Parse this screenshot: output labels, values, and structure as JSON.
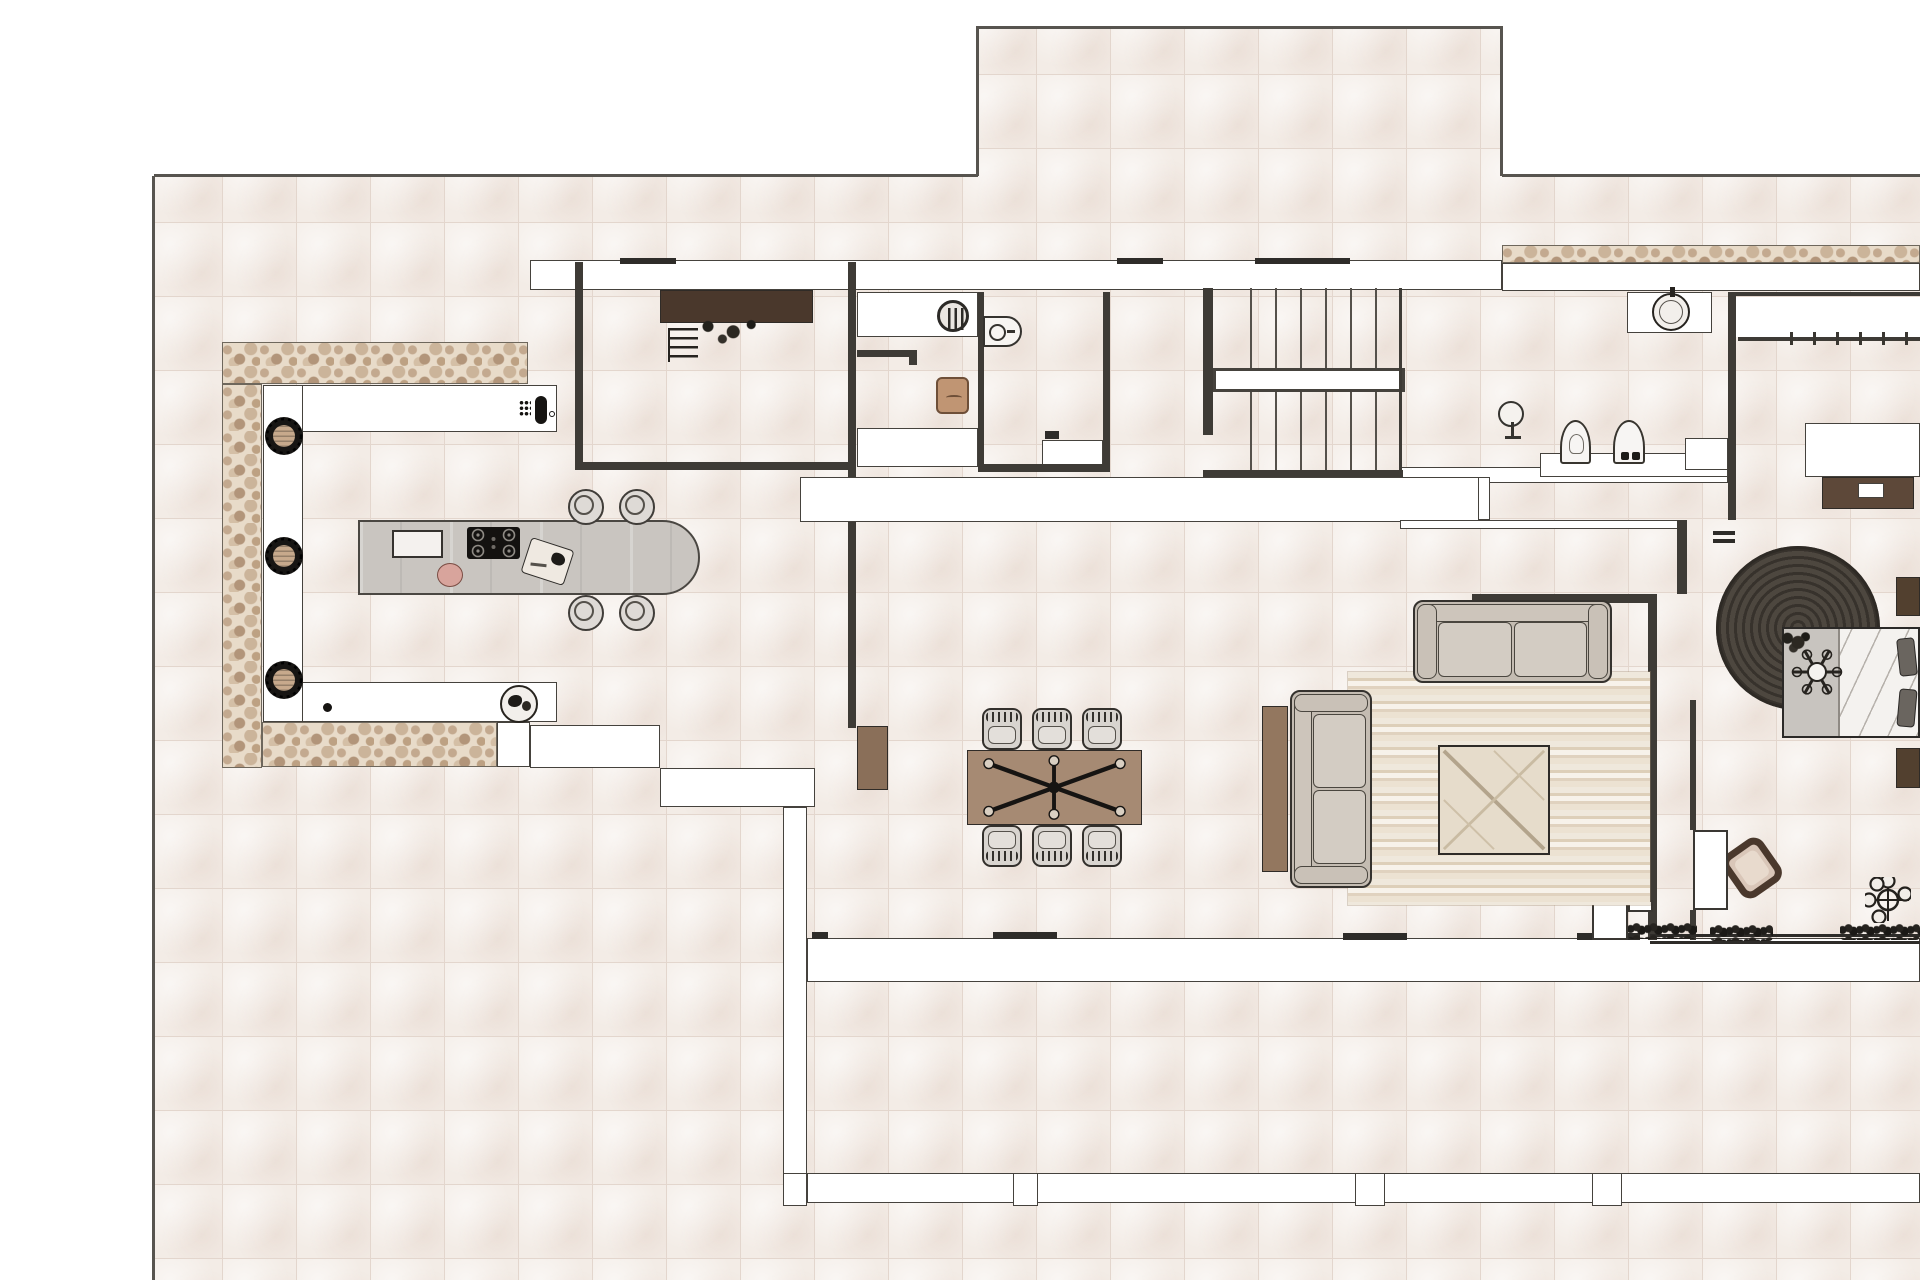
{
  "document": {
    "kind": "architectural-floor-plan",
    "title": "residential-floor-plan-top-view",
    "canvas": {
      "width": 1920,
      "height": 1280
    },
    "visible_text": [],
    "tile_size_px": 74
  },
  "palette": {
    "page": "#ffffff",
    "tile": "#f3ece6",
    "grout": "#e3d6cd",
    "wall_fill": "#ffffff",
    "wall_edge": "#45423d",
    "line": "#3e3b36",
    "boundary": "#57544f",
    "stone": "#e8dbc9",
    "island_gray": "#c9c5c0",
    "sofa_beige": "#cdc5bb",
    "wood_mid": "#a68a73",
    "wood_dark": "#4a382c",
    "wood_red": "#8a6f59",
    "rug_round": "#453f39",
    "tan": "#c7a98c",
    "pink": "#d8a49c",
    "hedge": "#1f1d1a",
    "black": "#161412",
    "chair_gray": "#d8d4cf"
  },
  "elements": [
    {
      "n": "site-tiles-left",
      "k": "tiles",
      "b": [
        154,
        176,
        824,
        1104
      ]
    },
    {
      "n": "site-tiles-upper",
      "k": "tiles",
      "b": [
        978,
        28,
        524,
        1252
      ]
    },
    {
      "n": "site-tiles-right",
      "k": "tiles",
      "b": [
        1502,
        176,
        418,
        1104
      ]
    },
    {
      "n": "boundary-left",
      "k": "line",
      "b": [
        152,
        176,
        3,
        1104
      ],
      "c": "#57544f"
    },
    {
      "n": "boundary-top-left",
      "k": "line",
      "b": [
        154,
        174,
        824,
        3
      ],
      "c": "#57544f"
    },
    {
      "n": "boundary-upper-terrace-left",
      "k": "line",
      "b": [
        976,
        28,
        3,
        148
      ],
      "c": "#57544f"
    },
    {
      "n": "boundary-upper-terrace-top",
      "k": "line",
      "b": [
        976,
        26,
        527,
        3
      ],
      "c": "#57544f"
    },
    {
      "n": "boundary-upper-terrace-right",
      "k": "line",
      "b": [
        1500,
        28,
        3,
        148
      ],
      "c": "#57544f"
    },
    {
      "n": "boundary-top-right",
      "k": "line",
      "b": [
        1502,
        174,
        418,
        3
      ],
      "c": "#57544f"
    },
    {
      "n": "stone-wall-kitchen-north",
      "k": "stone",
      "b": [
        222,
        342,
        306,
        42
      ]
    },
    {
      "n": "stone-wall-kitchen-west",
      "k": "stone",
      "b": [
        222,
        384,
        40,
        384
      ]
    },
    {
      "n": "stone-wall-kitchen-south",
      "k": "stone",
      "b": [
        262,
        722,
        235,
        45
      ]
    },
    {
      "n": "stone-band-northeast",
      "k": "stone",
      "b": [
        1502,
        245,
        418,
        18
      ]
    },
    {
      "n": "north-wall-band",
      "k": "wall",
      "b": [
        530,
        260,
        972,
        30
      ]
    },
    {
      "n": "north-wall-band-east",
      "k": "wall",
      "b": [
        1502,
        263,
        418,
        28
      ]
    },
    {
      "n": "kitchen-counter-top",
      "k": "wall",
      "b": [
        263,
        385,
        294,
        47
      ]
    },
    {
      "n": "kitchen-counter-left",
      "k": "wall",
      "b": [
        263,
        385,
        40,
        337
      ]
    },
    {
      "n": "kitchen-counter-bottom",
      "k": "wall",
      "b": [
        302,
        682,
        255,
        40
      ]
    },
    {
      "n": "south-wall-pillar",
      "k": "wall",
      "b": [
        497,
        722,
        33,
        45
      ]
    },
    {
      "n": "south-sill-kitchen",
      "k": "wall",
      "b": [
        530,
        725,
        130,
        43
      ]
    },
    {
      "n": "south-sill-step",
      "k": "wall",
      "b": [
        660,
        768,
        155,
        39
      ]
    },
    {
      "n": "west-glass-wall",
      "k": "wall",
      "b": [
        783,
        807,
        24,
        398
      ]
    },
    {
      "n": "south-wall-band",
      "k": "wall",
      "b": [
        807,
        938,
        1113,
        44
      ]
    },
    {
      "n": "terrace-parapet",
      "k": "wall",
      "b": [
        807,
        1173,
        1113,
        30
      ]
    },
    {
      "n": "parapet-post-1",
      "k": "wall",
      "b": [
        783,
        1173,
        24,
        33
      ]
    },
    {
      "n": "parapet-post-2",
      "k": "wall",
      "b": [
        1013,
        1173,
        25,
        33
      ]
    },
    {
      "n": "parapet-post-3",
      "k": "wall",
      "b": [
        1355,
        1173,
        30,
        33
      ]
    },
    {
      "n": "parapet-post-4",
      "k": "wall",
      "b": [
        1592,
        1173,
        30,
        33
      ]
    },
    {
      "n": "hall-wall-band",
      "k": "wall",
      "b": [
        1400,
        467,
        328,
        16
      ]
    },
    {
      "n": "hall-cabinet-row",
      "k": "wall",
      "b": [
        800,
        477,
        690,
        45
      ]
    },
    {
      "n": "hall-wall-lower",
      "k": "wall",
      "b": [
        1400,
        520,
        283,
        9
      ]
    },
    {
      "n": "hall-wall-connector",
      "k": "wall",
      "b": [
        1478,
        477,
        12,
        43
      ]
    },
    {
      "n": "laundry-closet-top",
      "k": "wall",
      "b": [
        857,
        292,
        121,
        45
      ]
    },
    {
      "n": "laundry-closet-bottom",
      "k": "wall",
      "b": [
        857,
        428,
        121,
        39
      ]
    },
    {
      "n": "stair-handrail",
      "k": "wall",
      "b": [
        1213,
        368,
        192,
        24
      ],
      "bw": "3px"
    },
    {
      "n": "bath-sink-counter",
      "k": "wall",
      "b": [
        1627,
        292,
        85,
        41
      ]
    },
    {
      "n": "bath-fixture-step",
      "k": "wall",
      "b": [
        1540,
        453,
        188,
        24
      ]
    },
    {
      "n": "shower-bench",
      "k": "wall",
      "b": [
        1042,
        440,
        61,
        27
      ]
    },
    {
      "n": "bath-wall-niche",
      "k": "wall",
      "b": [
        1685,
        438,
        43,
        32
      ]
    },
    {
      "n": "bedroom-closet-band",
      "k": "wall",
      "b": [
        1736,
        297,
        184,
        40
      ],
      "bw": "0px"
    },
    {
      "n": "wall-utility-west",
      "k": "line",
      "b": [
        575,
        262,
        8,
        205
      ]
    },
    {
      "n": "wall-dining-west-upper",
      "k": "line",
      "b": [
        848,
        262,
        8,
        215
      ]
    },
    {
      "n": "wall-dining-west-lower",
      "k": "line",
      "b": [
        848,
        522,
        8,
        206
      ]
    },
    {
      "n": "wall-shower-west",
      "k": "line",
      "b": [
        978,
        292,
        6,
        178
      ]
    },
    {
      "n": "wall-shower-east",
      "k": "line",
      "b": [
        1103,
        292,
        7,
        178
      ]
    },
    {
      "n": "wall-utility-south",
      "k": "line",
      "b": [
        575,
        462,
        281,
        8
      ]
    },
    {
      "n": "wall-shower-south",
      "k": "line",
      "b": [
        978,
        464,
        132,
        8
      ]
    },
    {
      "n": "wall-stairs-south",
      "k": "line",
      "b": [
        1203,
        470,
        200,
        7
      ]
    },
    {
      "n": "stair-left-rail",
      "k": "line",
      "b": [
        1203,
        288,
        10,
        147
      ]
    },
    {
      "n": "stair-right-edge",
      "k": "line",
      "b": [
        1399,
        288,
        3,
        182
      ]
    },
    {
      "n": "wall-lobby-south",
      "k": "line",
      "b": [
        1472,
        594,
        185,
        9
      ]
    },
    {
      "n": "wall-living-bedroom",
      "k": "line",
      "b": [
        1648,
        594,
        9,
        346
      ]
    },
    {
      "n": "wall-bath-bedroom",
      "k": "line",
      "b": [
        1728,
        292,
        8,
        228
      ]
    },
    {
      "n": "wall-bedroom-north",
      "k": "line",
      "b": [
        1736,
        292,
        184,
        4
      ]
    },
    {
      "n": "wall-lobby-east",
      "k": "line",
      "b": [
        1677,
        520,
        10,
        74
      ]
    },
    {
      "n": "wall-bedroom-west-upper",
      "k": "line",
      "b": [
        1690,
        700,
        6,
        130
      ]
    },
    {
      "n": "wall-bedroom-west-lower",
      "k": "line",
      "b": [
        1690,
        910,
        6,
        30
      ]
    },
    {
      "n": "closet-rail",
      "k": "line",
      "b": [
        1738,
        337,
        182,
        4
      ]
    },
    {
      "n": "closet-hanger-ticks",
      "k": "ticksv",
      "b": [
        1790,
        332,
        122,
        13
      ]
    },
    {
      "n": "door-hinge-tick-1",
      "k": "line",
      "b": [
        1713,
        531,
        22,
        4
      ],
      "c": "#2e2c29"
    },
    {
      "n": "door-hinge-tick-2",
      "k": "line",
      "b": [
        1713,
        539,
        22,
        4
      ],
      "c": "#2e2c29"
    },
    {
      "n": "threshold-south-1",
      "k": "line",
      "b": [
        812,
        932,
        16,
        7
      ],
      "c": "#2e2c29"
    },
    {
      "n": "threshold-south-2",
      "k": "line",
      "b": [
        993,
        932,
        64,
        7
      ],
      "c": "#2e2c29"
    },
    {
      "n": "threshold-south-3",
      "k": "line",
      "b": [
        1343,
        933,
        64,
        7
      ],
      "c": "#2e2c29"
    },
    {
      "n": "threshold-south-4",
      "k": "line",
      "b": [
        1577,
        933,
        63,
        7
      ],
      "c": "#2e2c29"
    },
    {
      "n": "threshold-north-1",
      "k": "line",
      "b": [
        620,
        258,
        56,
        6
      ],
      "c": "#2e2c29"
    },
    {
      "n": "threshold-north-2",
      "k": "line",
      "b": [
        1117,
        258,
        46,
        6
      ],
      "c": "#2e2c29"
    },
    {
      "n": "threshold-north-3",
      "k": "line",
      "b": [
        1255,
        258,
        95,
        6
      ],
      "c": "#2e2c29"
    },
    {
      "n": "bedroom-glazing-1",
      "k": "line",
      "b": [
        1650,
        934,
        270,
        3
      ],
      "c": "#2e2c29"
    },
    {
      "n": "bedroom-glazing-2",
      "k": "line",
      "b": [
        1650,
        941,
        270,
        3
      ],
      "c": "#2e2c29"
    },
    {
      "n": "stair-treads-upper",
      "k": "treads",
      "b": [
        1250,
        288,
        150,
        80
      ]
    },
    {
      "n": "stair-treads-lower",
      "k": "treads",
      "b": [
        1250,
        392,
        150,
        78
      ]
    },
    {
      "n": "hedge-planter-1",
      "k": "hedge",
      "b": [
        1628,
        923,
        69,
        16
      ]
    },
    {
      "n": "hedge-planter-2",
      "k": "hedge",
      "b": [
        1710,
        925,
        63,
        16
      ]
    },
    {
      "n": "hedge-planter-3",
      "k": "hedge",
      "b": [
        1840,
        924,
        80,
        16
      ]
    },
    {
      "n": "utility-wood-counter",
      "k": "woodrect",
      "b": [
        660,
        290,
        153,
        33
      ],
      "c": "#4a382c",
      "g": "h"
    },
    {
      "n": "utility-plant",
      "k": "scrib",
      "b": [
        690,
        312,
        72,
        36
      ]
    },
    {
      "n": "utility-ladder",
      "k": "ladder",
      "b": [
        668,
        328,
        30,
        34
      ]
    },
    {
      "n": "washing-machine",
      "k": "washer",
      "c2": [
        953,
        316
      ],
      "r": 16
    },
    {
      "n": "laundry-rail",
      "k": "line",
      "b": [
        857,
        350,
        60,
        7
      ]
    },
    {
      "n": "laundry-rail-hook",
      "k": "line",
      "b": [
        909,
        355,
        8,
        10
      ]
    },
    {
      "n": "laundry-basket",
      "k": "basket",
      "b": [
        936,
        377,
        33,
        37
      ]
    },
    {
      "n": "shower-washbasin",
      "k": "basin",
      "b": [
        983,
        316,
        39,
        31
      ]
    },
    {
      "n": "toilet-paper-holder",
      "k": "line",
      "b": [
        1045,
        431,
        14,
        8
      ],
      "c": "#2e2c29"
    },
    {
      "n": "bath-floor-lamp",
      "k": "lamp",
      "c2": [
        1511,
        414
      ],
      "r": 13
    },
    {
      "n": "toilet",
      "k": "arch",
      "b": [
        1560,
        420,
        31,
        44
      ],
      "v": 0
    },
    {
      "n": "bidet",
      "k": "arch",
      "b": [
        1613,
        420,
        32,
        44
      ],
      "v": 1
    },
    {
      "n": "vessel-sink",
      "k": "vessel",
      "c2": [
        1671,
        312
      ],
      "r": 19
    },
    {
      "n": "bedroom-desk-top",
      "k": "wall",
      "b": [
        1805,
        423,
        115,
        54
      ]
    },
    {
      "n": "bedroom-desk-wood",
      "k": "woodrect",
      "b": [
        1822,
        477,
        92,
        32
      ],
      "c": "#5d4839",
      "g": "h"
    },
    {
      "n": "desk-object",
      "k": "wall",
      "b": [
        1858,
        483,
        26,
        15
      ]
    },
    {
      "n": "bedroom-round-rug",
      "k": "ruground",
      "c2": [
        1798,
        628
      ],
      "r": 82
    },
    {
      "n": "bed",
      "k": "bed",
      "b": [
        1782,
        627,
        138,
        111
      ]
    },
    {
      "n": "ceiling-fan",
      "k": "fan",
      "c2": [
        1817,
        672
      ],
      "r": 27
    },
    {
      "n": "nightstand-top",
      "k": "woodrect",
      "b": [
        1896,
        577,
        24,
        39
      ],
      "c": "#52402f",
      "g": "v"
    },
    {
      "n": "nightstand-bottom",
      "k": "woodrect",
      "b": [
        1896,
        748,
        24,
        40
      ],
      "c": "#52402f",
      "g": "v"
    },
    {
      "n": "bedroom-lounge-chair",
      "k": "lounge",
      "b": [
        1728,
        842,
        48,
        52
      ],
      "rot": -35
    },
    {
      "n": "potted-plant",
      "k": "plantpot",
      "c2": [
        1888,
        900
      ],
      "r": 23
    },
    {
      "n": "bedroom-door-leaf",
      "k": "door",
      "b": [
        1693,
        830,
        35,
        80
      ]
    },
    {
      "n": "terrace-door-leaf",
      "k": "door",
      "b": [
        1592,
        900,
        36,
        40
      ]
    },
    {
      "n": "terrace-door-step",
      "k": "door",
      "b": [
        1628,
        900,
        25,
        12
      ]
    },
    {
      "n": "kitchen-island",
      "k": "island",
      "b": [
        358,
        520,
        342,
        75
      ]
    },
    {
      "n": "island-sink",
      "k": "outrect",
      "b": [
        392,
        530,
        51,
        28
      ],
      "c": "#f4f1ee"
    },
    {
      "n": "island-hob",
      "k": "hob",
      "b": [
        467,
        527,
        53,
        32
      ]
    },
    {
      "n": "cutting-board",
      "k": "board",
      "b": [
        525,
        543,
        45,
        37
      ],
      "rot": 18
    },
    {
      "n": "serving-tray",
      "k": "ellipse",
      "b": [
        437,
        563,
        26,
        24
      ],
      "c": "#d8a49c",
      "bc": "#7a4c43"
    },
    {
      "n": "bar-chair-1",
      "k": "barchair",
      "c2": [
        586,
        507
      ],
      "r": 18
    },
    {
      "n": "bar-chair-2",
      "k": "barchair",
      "c2": [
        637,
        507
      ],
      "r": 18
    },
    {
      "n": "bar-chair-3",
      "k": "barchair",
      "c2": [
        586,
        613
      ],
      "r": 18
    },
    {
      "n": "bar-chair-4",
      "k": "barchair",
      "c2": [
        637,
        613
      ],
      "r": 18
    },
    {
      "n": "counter-faucet",
      "k": "faucet",
      "b": [
        519,
        394,
        36,
        34
      ]
    },
    {
      "n": "counter-drain-dot",
      "k": "ellipse",
      "b": [
        323,
        703,
        9,
        9
      ],
      "c": "#161412",
      "bc": "#161412"
    },
    {
      "n": "fruit-bowl",
      "k": "bowl",
      "c2": [
        519,
        704
      ],
      "r": 19
    },
    {
      "n": "counter-stool-1",
      "k": "stool",
      "c2": [
        284,
        436
      ],
      "r": 19
    },
    {
      "n": "counter-stool-2",
      "k": "stool",
      "c2": [
        284,
        556
      ],
      "r": 19
    },
    {
      "n": "counter-stool-3",
      "k": "stool",
      "c2": [
        284,
        680
      ],
      "r": 19
    },
    {
      "n": "dining-sideboard",
      "k": "woodrect",
      "b": [
        857,
        726,
        31,
        64
      ],
      "c": "#8a6f59",
      "g": "v"
    },
    {
      "n": "dining-table",
      "k": "tablex",
      "b": [
        967,
        750,
        175,
        75
      ]
    },
    {
      "n": "dining-chair-1",
      "k": "dchair",
      "b": [
        982,
        708,
        40,
        42
      ],
      "v": 0
    },
    {
      "n": "dining-chair-2",
      "k": "dchair",
      "b": [
        1032,
        708,
        40,
        42
      ],
      "v": 0
    },
    {
      "n": "dining-chair-3",
      "k": "dchair",
      "b": [
        1082,
        708,
        40,
        42
      ],
      "v": 0
    },
    {
      "n": "dining-chair-4",
      "k": "dchair",
      "b": [
        982,
        825,
        40,
        42
      ],
      "v": 1
    },
    {
      "n": "dining-chair-5",
      "k": "dchair",
      "b": [
        1032,
        825,
        40,
        42
      ],
      "v": 1
    },
    {
      "n": "dining-chair-6",
      "k": "dchair",
      "b": [
        1082,
        825,
        40,
        42
      ],
      "v": 1
    },
    {
      "n": "living-rug",
      "k": "rugstr",
      "b": [
        1348,
        672,
        302,
        233
      ]
    },
    {
      "n": "sofa-console",
      "k": "woodrect",
      "b": [
        1262,
        706,
        26,
        166
      ],
      "c": "#93775f",
      "g": "v"
    },
    {
      "n": "sofa-vertical",
      "k": "sofa",
      "b": [
        1290,
        690,
        82,
        198
      ],
      "o": "v"
    },
    {
      "n": "sofa-horizontal",
      "k": "sofa",
      "b": [
        1413,
        600,
        199,
        83
      ],
      "o": "h"
    },
    {
      "n": "coffee-table",
      "k": "coffee",
      "b": [
        1438,
        745,
        112,
        110
      ]
    }
  ]
}
